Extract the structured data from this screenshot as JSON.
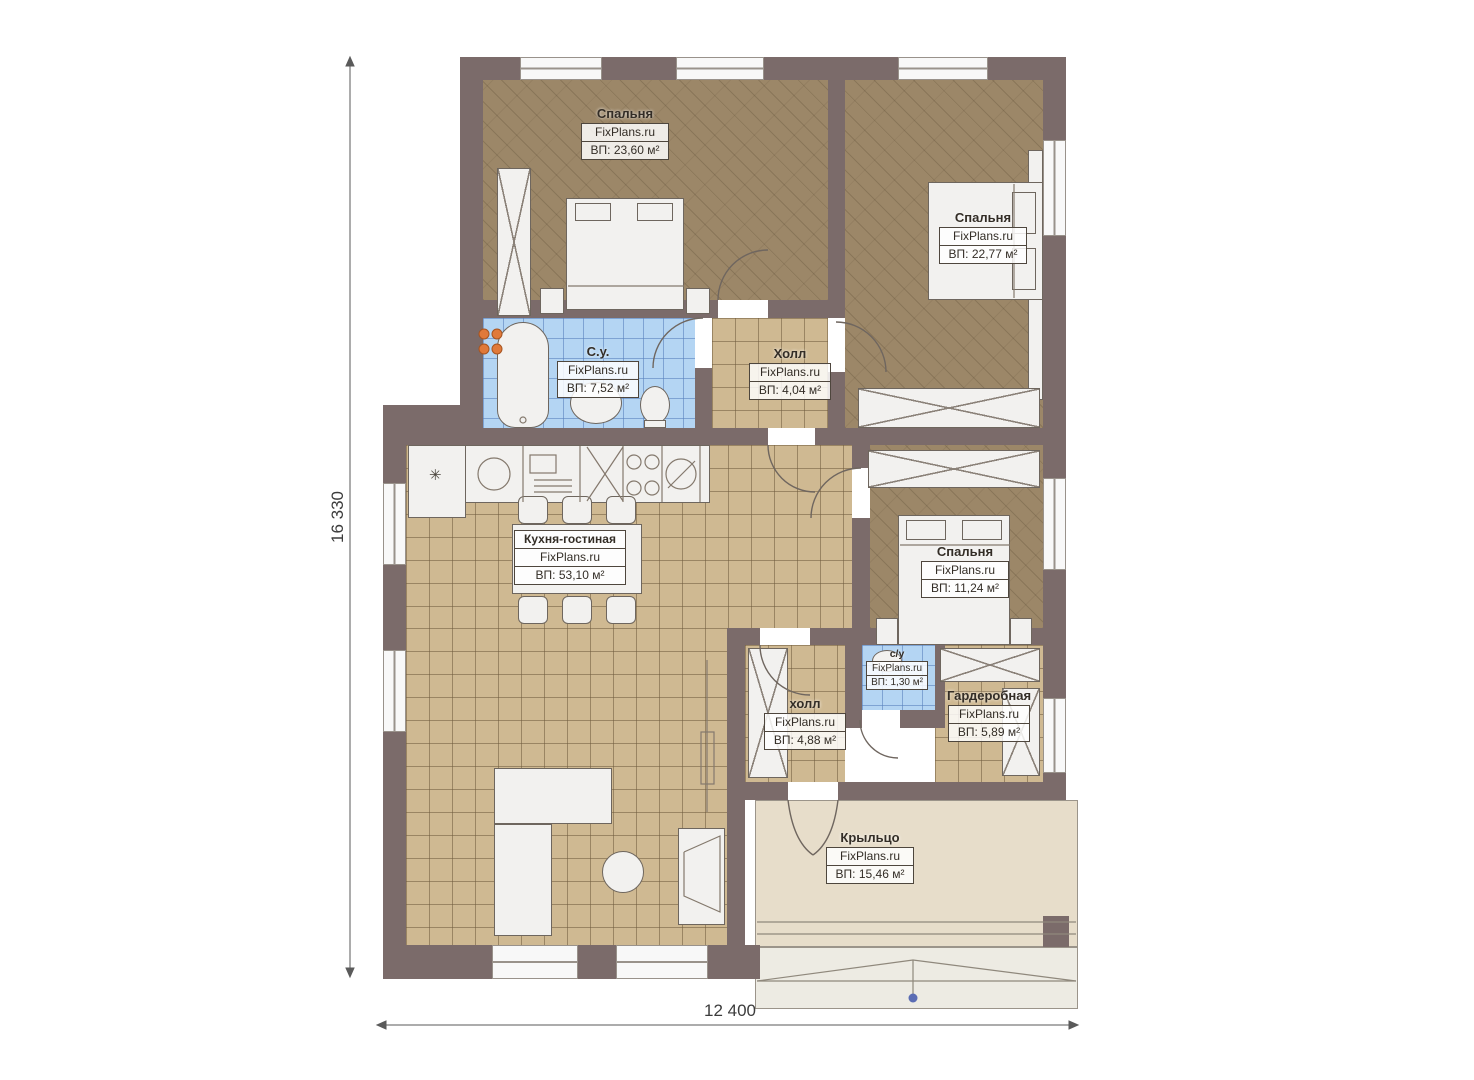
{
  "plan_title": "one-storey house floor plan",
  "brand": "FixPlans.ru",
  "rooms": [
    {
      "id": "bedroom-1",
      "name": "Спальня",
      "brand": "FixPlans.ru",
      "area": "ВП: 23,60 м²"
    },
    {
      "id": "bedroom-2",
      "name": "Спальня",
      "brand": "FixPlans.ru",
      "area": "ВП: 22,77 м²"
    },
    {
      "id": "bathroom",
      "name": "С.у.",
      "brand": "FixPlans.ru",
      "area": "ВП: 7,52 м²"
    },
    {
      "id": "hall",
      "name": "Холл",
      "brand": "FixPlans.ru",
      "area": "ВП: 4,04 м²"
    },
    {
      "id": "kitchen-living",
      "name": "Кухня-гостиная",
      "brand": "FixPlans.ru",
      "area": "ВП: 53,10 м²"
    },
    {
      "id": "bedroom-3",
      "name": "Спальня",
      "brand": "FixPlans.ru",
      "area": "ВП: 11,24 м²"
    },
    {
      "id": "wc",
      "name": "с/у",
      "brand": "FixPlans.ru",
      "area": "ВП: 1,30 м²"
    },
    {
      "id": "wardrobe",
      "name": "Гардеробная",
      "brand": "FixPlans.ru",
      "area": "ВП: 5,89 м²"
    },
    {
      "id": "hall-2",
      "name": "холл",
      "brand": "FixPlans.ru",
      "area": "ВП: 4,88 м²"
    },
    {
      "id": "porch",
      "name": "Крыльцо",
      "brand": "FixPlans.ru",
      "area": "ВП: 15,46 м²"
    }
  ],
  "dimensions": {
    "height_label": "16 330",
    "width_label": "12 400"
  },
  "symbols": {
    "boiler": "✳"
  },
  "colors": {
    "wall": "#7b6b6a",
    "wood_floor": "#9c8768",
    "tile_floor": "#cfb992",
    "wet_floor": "#b4d5f3",
    "porch_floor": "#e7ddca",
    "radiator": "#e0793a",
    "ramp_dot": "#5b6db4"
  }
}
